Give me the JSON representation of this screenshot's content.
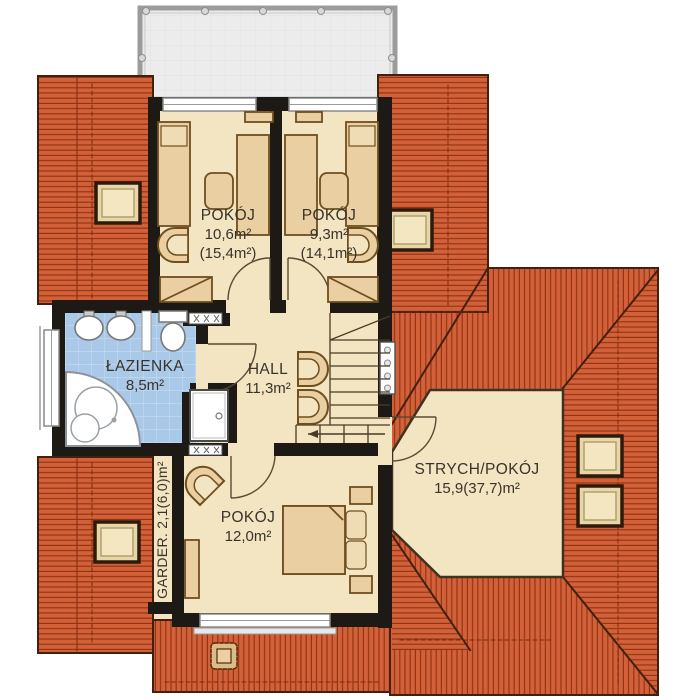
{
  "plan_title": "Floor plan - upper storey",
  "rooms": {
    "pokoj_top_left": {
      "name": "POKÓJ",
      "area": "10,6m²",
      "area_total": "(15,4m²)"
    },
    "pokoj_top_right": {
      "name": "POKÓJ",
      "area": "9,3m²",
      "area_total": "(14,1m²)"
    },
    "lazienka": {
      "name": "ŁAZIENKA",
      "area": "8,5m²"
    },
    "hall": {
      "name": "HALL",
      "area": "11,3m²"
    },
    "strych": {
      "name": "STRYCH/POKÓJ",
      "area": "15,9(37,7)m²"
    },
    "pokoj_bottom": {
      "name": "POKÓJ",
      "area": "12,0m²"
    },
    "garderoba": {
      "name": "GARDER.",
      "area": "2,1(6,0)m²"
    }
  },
  "colors": {
    "roof": "#d2613a",
    "roof_line": "#8f3110",
    "roof_edge": "#43200e",
    "floor": "#f3e4c2",
    "bathroom_tile": "#aac8e8",
    "wall": "#1d1a16",
    "furniture": "#e9cfa2",
    "furniture_outline": "#6f4e1e",
    "balcony": "#ececec",
    "fixture_white": "#ffffff"
  }
}
